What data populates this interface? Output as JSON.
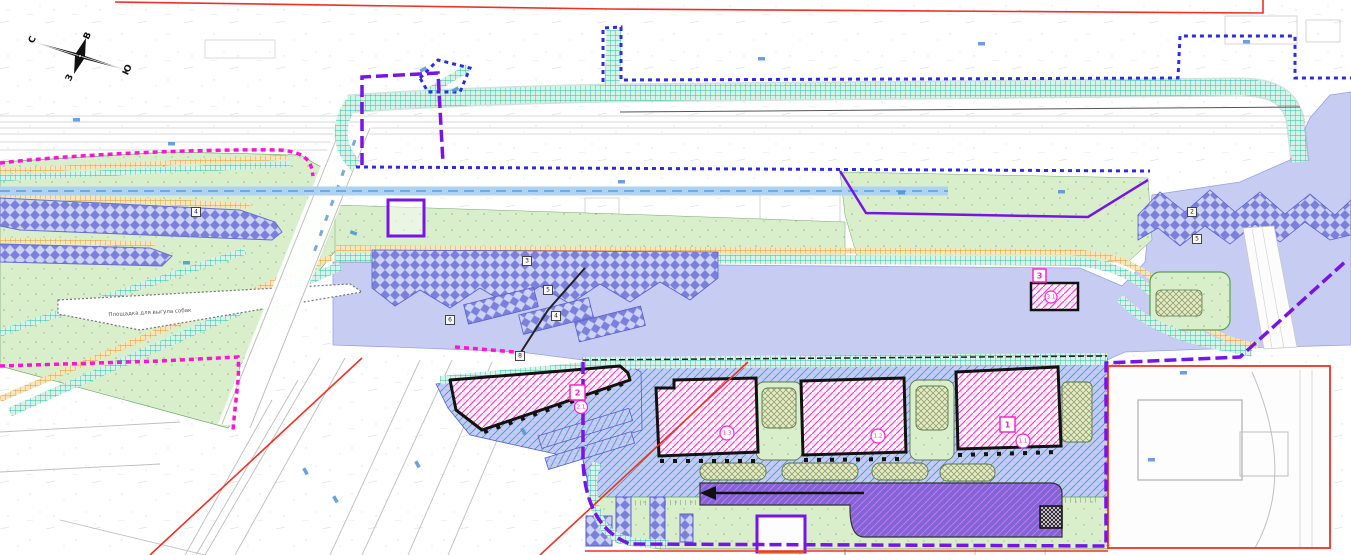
{
  "plan": {
    "compass": {
      "n": "С",
      "e": "В",
      "s": "Ю",
      "w": "З"
    },
    "labels": {
      "dog_walk": "Площадка для выгула собак"
    },
    "blocks": {
      "b1_tag": "1",
      "b1_unit": "1.1",
      "b12_unit": "1.2",
      "b13_unit": "1.3",
      "b2_tag": "2",
      "b2_unit": "2.1",
      "b3_tag": "3",
      "b3_unit": "3.1"
    },
    "refs": {
      "r1": "3",
      "r2": "5",
      "r3": "4",
      "r4": "6",
      "r5": "8",
      "r6": "2",
      "r7": "5",
      "r8": "4"
    },
    "colors": {
      "boundary_red": "#ee3124",
      "boundary_blue": "#2d2de0",
      "boundary_magenta": "#ff14d2",
      "boundary_purple": "#7714e6",
      "greenery": "#d9efcc",
      "paving_lavender": "#c7ccf3",
      "path_teal": "#25bfae",
      "path_orange": "#de9a2e",
      "building_pink": "#ff3fd1",
      "parking_purple": "#7b80dd",
      "road_purple": "#8165d8",
      "water_blue": "#aed3f2"
    }
  }
}
